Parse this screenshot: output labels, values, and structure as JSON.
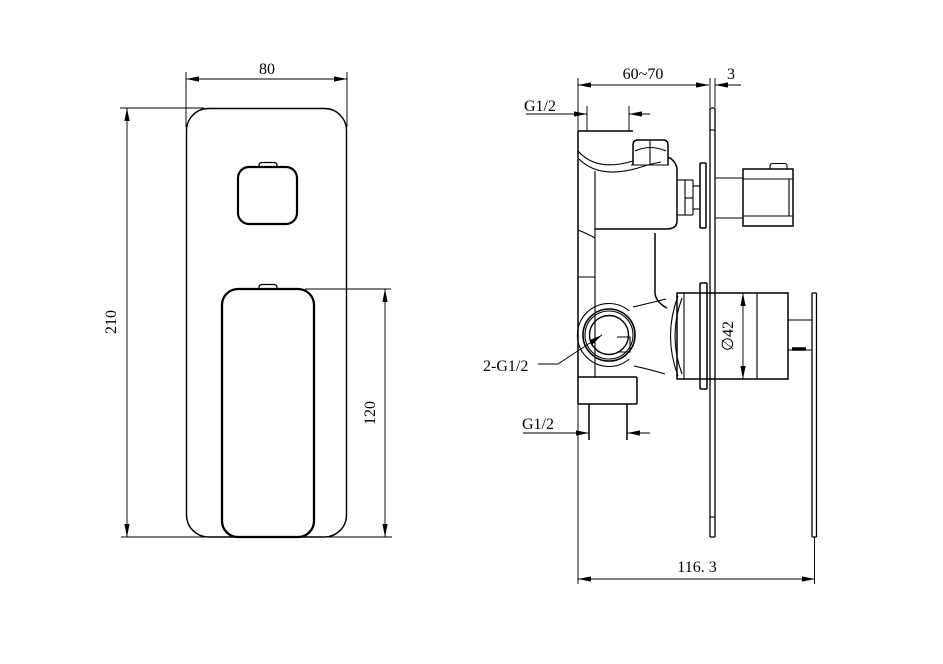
{
  "colors": {
    "background": "#ffffff",
    "line": "#000000"
  },
  "front_view": {
    "dims": {
      "plate_width": "80",
      "plate_height": "210",
      "handle_height": "120"
    }
  },
  "side_view": {
    "dims": {
      "install_depth": "60~70",
      "plate_thickness": "3",
      "top_outlet_thread": "G1/2",
      "inlet_threads": "2-G1/2",
      "bottom_outlet_thread": "G1/2",
      "trim_diameter": "∅42",
      "overall_depth": "116. 3"
    }
  }
}
